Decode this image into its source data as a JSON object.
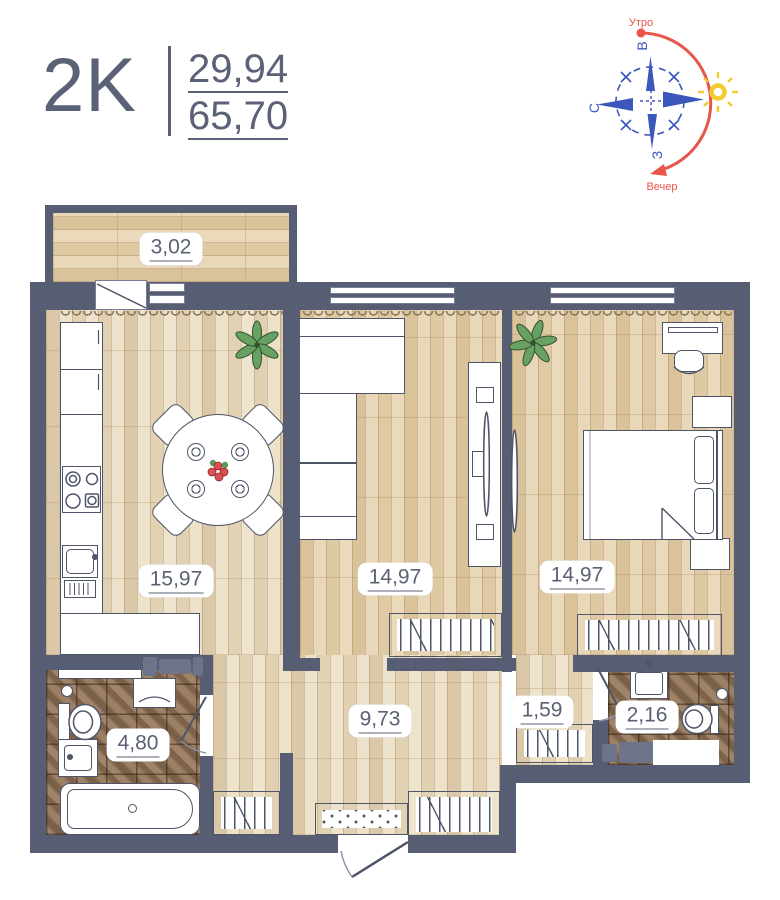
{
  "header": {
    "apartment_type": "2K",
    "living_area": "29,94",
    "total_area": "65,70"
  },
  "compass": {
    "morning": "Утро",
    "evening": "Вечер",
    "dir_top": "В",
    "dir_left": "С",
    "dir_bottom": "З"
  },
  "rooms": {
    "balcony": {
      "name": "balcony",
      "area": "3,02"
    },
    "kitchen": {
      "name": "kitchen-living",
      "area": "15,97"
    },
    "living": {
      "name": "living-room",
      "area": "14,97"
    },
    "bedroom": {
      "name": "bedroom",
      "area": "14,97"
    },
    "hallway": {
      "name": "hallway",
      "area": "9,73"
    },
    "bathroom": {
      "name": "bathroom",
      "area": "4,80"
    },
    "niche": {
      "name": "wardrobe-niche",
      "area": "1,59"
    },
    "wc": {
      "name": "wc",
      "area": "2,16"
    }
  },
  "colors": {
    "wall": "#575d72",
    "accent_text": "#5b6277",
    "compass_blue": "#3b57bb",
    "compass_red": "#e8554b",
    "sun_yellow": "#f3cb2e",
    "floor_light": "#ece1c9",
    "floor_tan": "#e7d6b6",
    "tile_brown": "#8b6f56"
  }
}
